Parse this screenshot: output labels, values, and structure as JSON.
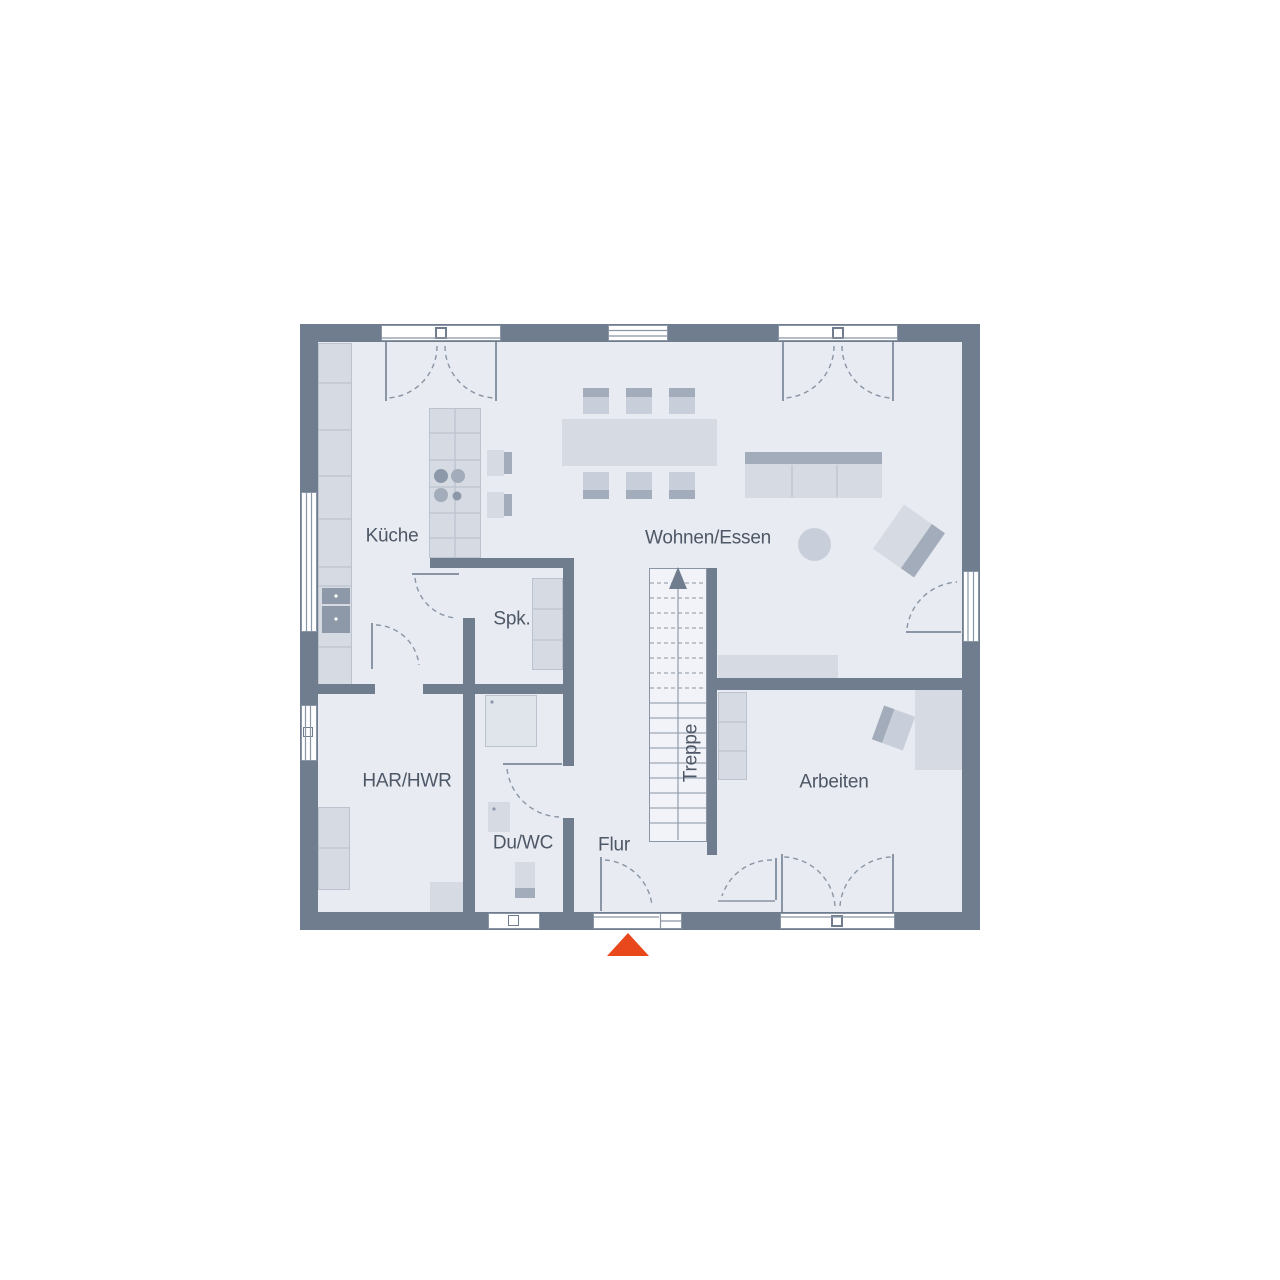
{
  "title": "Grundriss Erdgeschoss",
  "rooms": {
    "kitchen": "Küche",
    "living_dining": "Wohnen/Essen",
    "pantry": "Spk.",
    "stairs": "Treppe",
    "utility": "HAR/HWR",
    "shower_wc": "Du/WC",
    "hallway": "Flur",
    "office": "Arbeiten"
  },
  "markers": {
    "entrance": {
      "icon": "entrance-arrow-icon",
      "shape": "triangle-up",
      "color_ref": "accent"
    }
  },
  "colors": {
    "wall": "#6F7D8E",
    "floor": "#E8EBF1",
    "stairs_floor": "#F1F3F8",
    "furn_light": "#D6DAE3",
    "furn_mid": "#C9CFDA",
    "furn_dark": "#A3ACBA",
    "appliance": "#8D99A9",
    "fixture": "#E0E4EB",
    "line": "#8A95A5",
    "line_soft": "#BCC3CF",
    "text": "#4E5766",
    "accent": "#E8481B"
  }
}
